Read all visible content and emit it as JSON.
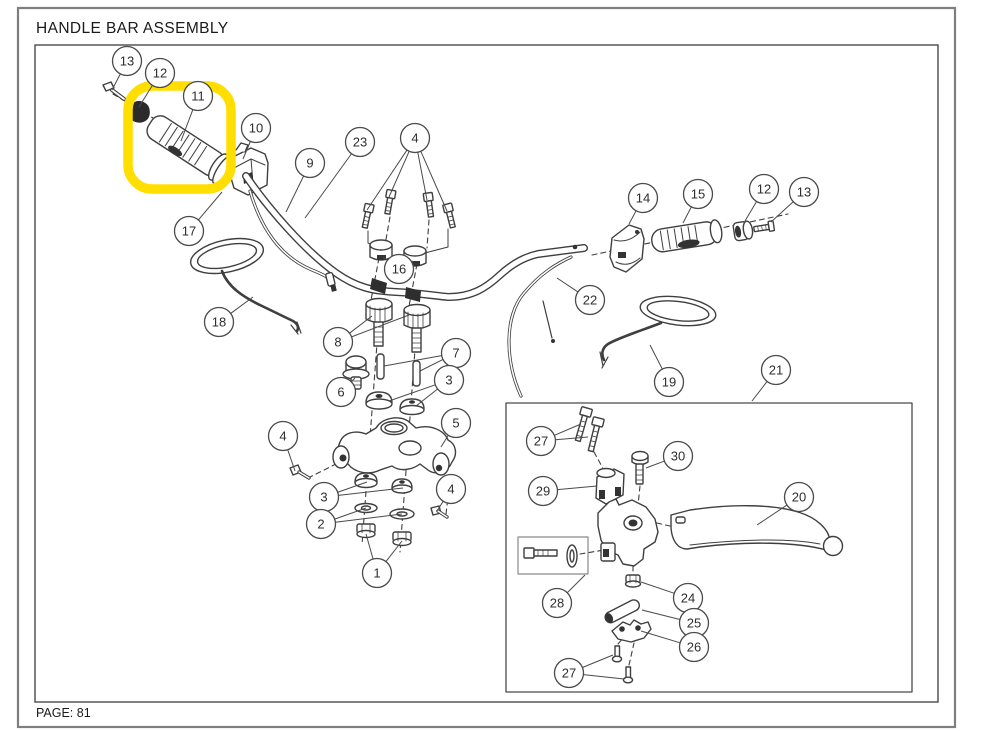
{
  "header": {
    "title": "HANDLE BAR ASSEMBLY"
  },
  "footer": {
    "page_label": "PAGE: 81"
  },
  "diagram": {
    "description": "Exploded parts diagram of a handle bar assembly",
    "highlight": {
      "part_label": "11",
      "color": "#FFDE00"
    },
    "part_numbers_shown": [
      "1",
      "2",
      "3",
      "4",
      "5",
      "6",
      "7",
      "8",
      "9",
      "10",
      "11",
      "12",
      "13",
      "14",
      "15",
      "16",
      "17",
      "18",
      "19",
      "20",
      "21",
      "22",
      "23",
      "24",
      "25",
      "26",
      "27",
      "28",
      "29",
      "30"
    ],
    "callouts": [
      {
        "label": "13",
        "x": 127,
        "y": 61,
        "leaders": [
          [
            112,
            90
          ]
        ]
      },
      {
        "label": "12",
        "x": 160,
        "y": 73,
        "leaders": [
          [
            139,
            107
          ]
        ]
      },
      {
        "label": "11",
        "x": 198,
        "y": 96,
        "leaders": [
          [
            181,
            141
          ]
        ]
      },
      {
        "label": "10",
        "x": 256,
        "y": 128,
        "leaders": [
          [
            243,
            159
          ]
        ]
      },
      {
        "label": "9",
        "x": 310,
        "y": 163,
        "leaders": [
          [
            286,
            212
          ]
        ]
      },
      {
        "label": "23",
        "x": 360,
        "y": 142,
        "leaders": [
          [
            305,
            218
          ]
        ]
      },
      {
        "label": "4",
        "x": 415,
        "y": 138,
        "leaders": [
          [
            367,
            210
          ],
          [
            389,
            197
          ],
          [
            427,
            200
          ],
          [
            447,
            211
          ]
        ]
      },
      {
        "label": "16",
        "x": 399,
        "y": 269,
        "leaders": [
          [
            383,
            257
          ],
          [
            413,
            261
          ]
        ]
      },
      {
        "label": "17",
        "x": 189,
        "y": 231,
        "leaders": [
          [
            222,
            192
          ]
        ]
      },
      {
        "label": "18",
        "x": 219,
        "y": 322,
        "leaders": [
          [
            253,
            297
          ]
        ]
      },
      {
        "label": "8",
        "x": 338,
        "y": 342,
        "leaders": [
          [
            372,
            316
          ],
          [
            409,
            315
          ]
        ]
      },
      {
        "label": "7",
        "x": 456,
        "y": 353,
        "leaders": [
          [
            384,
            366
          ],
          [
            420,
            371
          ]
        ]
      },
      {
        "label": "6",
        "x": 341,
        "y": 392,
        "leaders": [
          [
            355,
            378
          ]
        ]
      },
      {
        "label": "3",
        "x": 449,
        "y": 380,
        "leaders": [
          [
            389,
            401
          ],
          [
            416,
            406
          ]
        ]
      },
      {
        "label": "5",
        "x": 456,
        "y": 423,
        "leaders": [
          [
            441,
            447
          ]
        ]
      },
      {
        "label": "4",
        "x": 283,
        "y": 436,
        "leaders": [
          [
            295,
            471
          ]
        ]
      },
      {
        "label": "3",
        "x": 324,
        "y": 497,
        "leaders": [
          [
            367,
            482
          ],
          [
            403,
            488
          ]
        ]
      },
      {
        "label": "2",
        "x": 321,
        "y": 524,
        "leaders": [
          [
            366,
            508
          ],
          [
            402,
            514
          ]
        ]
      },
      {
        "label": "4",
        "x": 451,
        "y": 489,
        "leaders": [
          [
            437,
            511
          ]
        ]
      },
      {
        "label": "1",
        "x": 377,
        "y": 573,
        "leaders": [
          [
            366,
            534
          ],
          [
            402,
            541
          ]
        ]
      },
      {
        "label": "14",
        "x": 643,
        "y": 198,
        "leaders": [
          [
            629,
            224
          ]
        ]
      },
      {
        "label": "15",
        "x": 698,
        "y": 194,
        "leaders": [
          [
            683,
            223
          ]
        ]
      },
      {
        "label": "12",
        "x": 764,
        "y": 189,
        "leaders": [
          [
            745,
            221
          ]
        ]
      },
      {
        "label": "13",
        "x": 804,
        "y": 192,
        "leaders": [
          [
            771,
            222
          ]
        ]
      },
      {
        "label": "22",
        "x": 590,
        "y": 300,
        "leaders": [
          [
            557,
            278
          ]
        ]
      },
      {
        "label": "19",
        "x": 669,
        "y": 382,
        "leaders": [
          [
            650,
            345
          ]
        ]
      },
      {
        "label": "21",
        "x": 776,
        "y": 370,
        "leaders": [
          [
            752,
            401
          ]
        ]
      },
      {
        "label": "27",
        "x": 541,
        "y": 441,
        "leaders": [
          [
            581,
            424
          ],
          [
            588,
            437
          ]
        ]
      },
      {
        "label": "29",
        "x": 543,
        "y": 491,
        "leaders": [
          [
            597,
            486
          ]
        ]
      },
      {
        "label": "30",
        "x": 678,
        "y": 456,
        "leaders": [
          [
            646,
            468
          ]
        ]
      },
      {
        "label": "20",
        "x": 799,
        "y": 497,
        "leaders": [
          [
            757,
            525
          ]
        ]
      },
      {
        "label": "28",
        "x": 557,
        "y": 603,
        "leaders": [
          [
            585,
            575
          ]
        ]
      },
      {
        "label": "24",
        "x": 688,
        "y": 598,
        "leaders": [
          [
            641,
            582
          ]
        ]
      },
      {
        "label": "25",
        "x": 694,
        "y": 623,
        "leaders": [
          [
            642,
            610
          ]
        ]
      },
      {
        "label": "26",
        "x": 694,
        "y": 647,
        "leaders": [
          [
            641,
            631
          ]
        ]
      },
      {
        "label": "27",
        "x": 569,
        "y": 673,
        "leaders": [
          [
            613,
            655
          ],
          [
            624,
            679
          ]
        ]
      }
    ]
  }
}
